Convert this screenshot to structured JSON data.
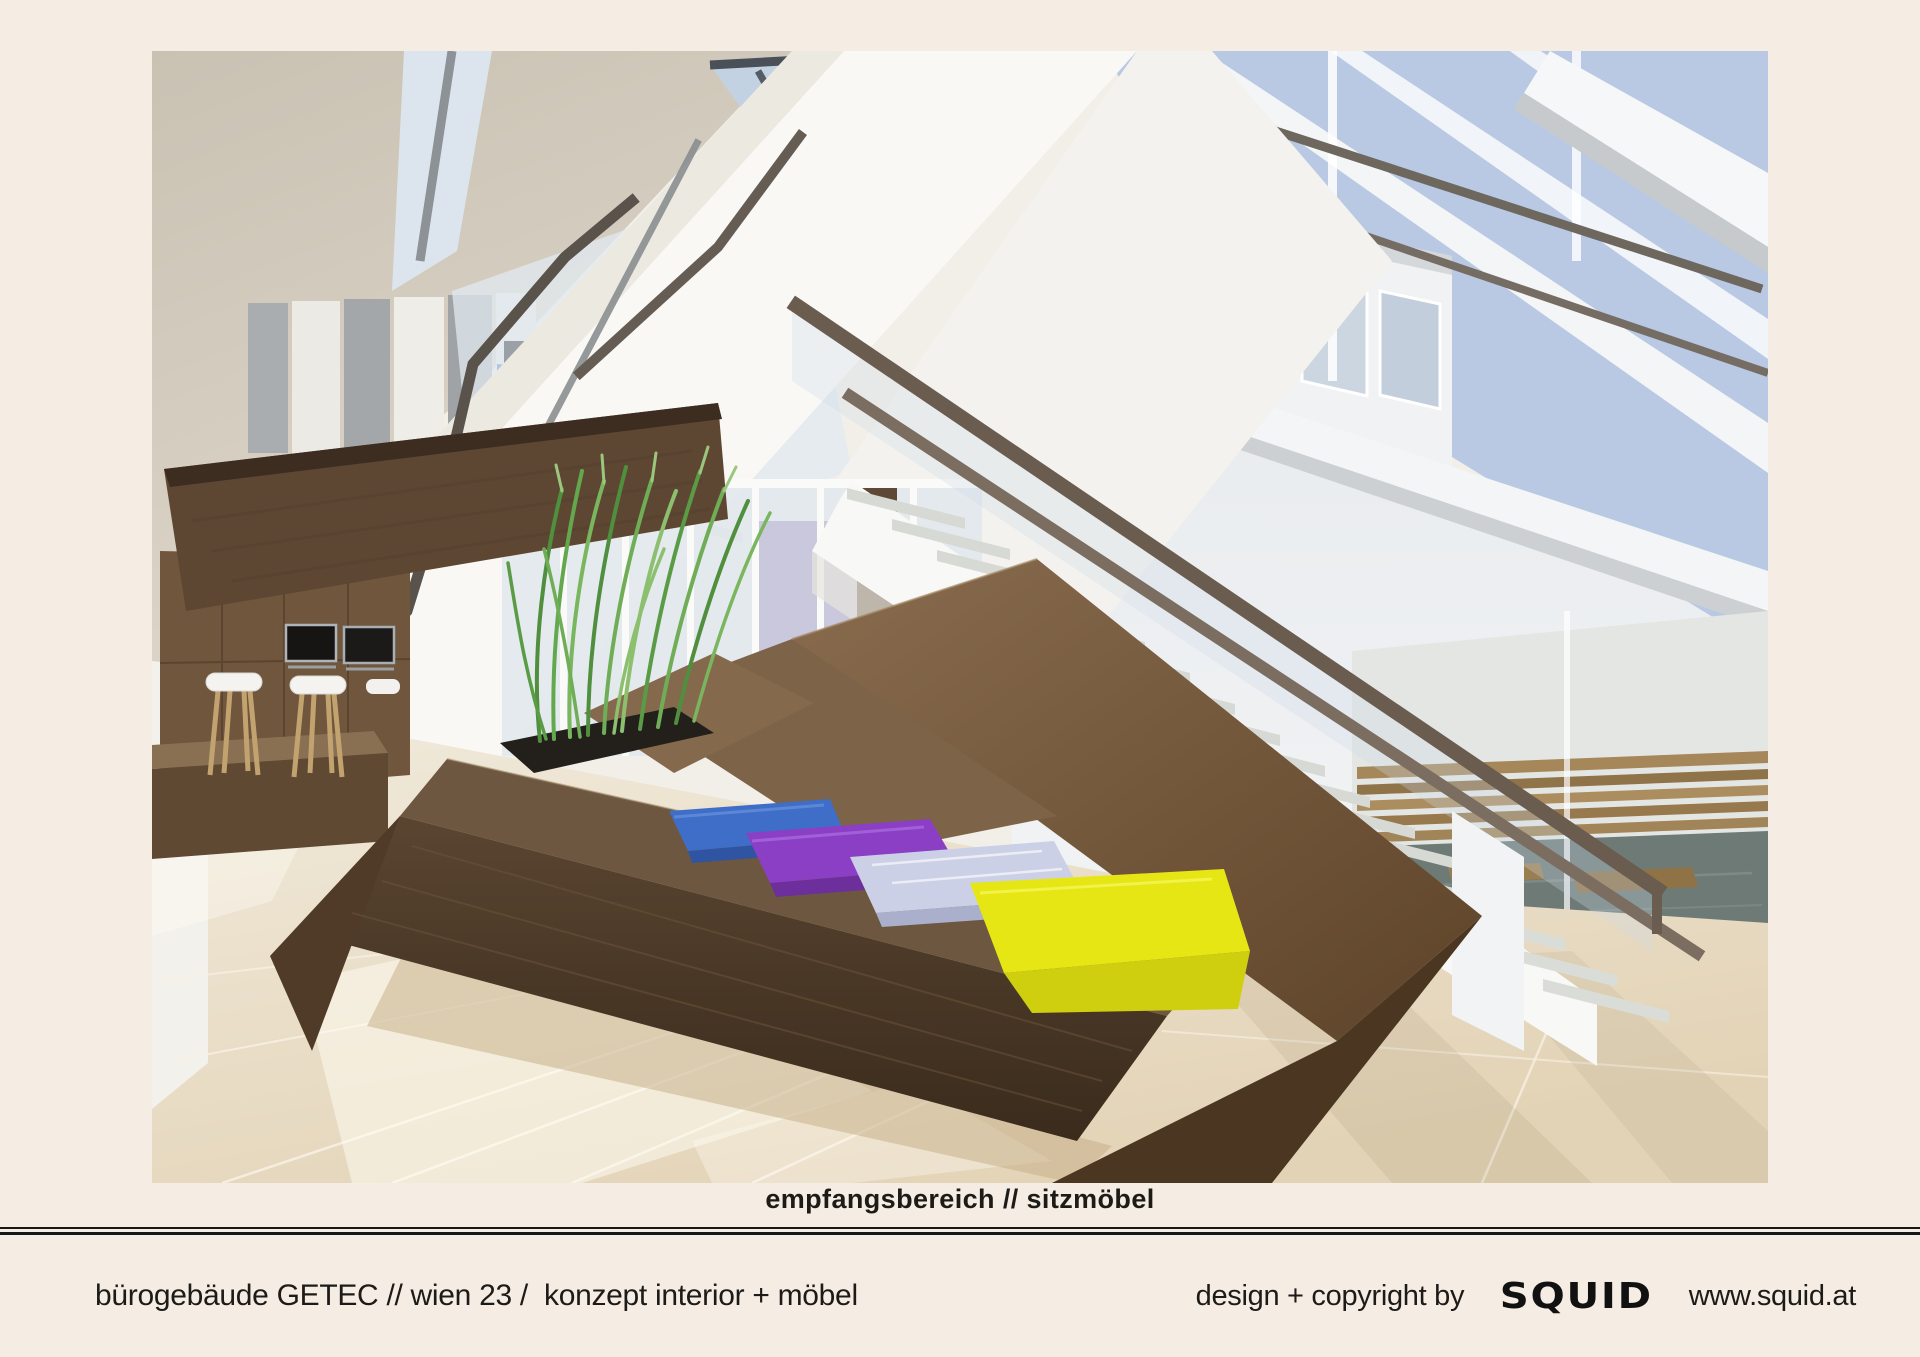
{
  "page": {
    "background_color": "#f5ece4",
    "caption": "empfangsbereich // sitzmöbel"
  },
  "footer": {
    "project": "bürogebäude GETEC // wien 23 /  konzept interior + möbel",
    "credit": "design + copyright by",
    "brand": "SQUID",
    "website": "www.squid.at",
    "rule_color": "#171717",
    "text_color": "#1d1b18"
  },
  "rendering": {
    "description": "3D-Rendering Empfangsbereich: skulpturales Sitzmöbel aus Holz mit vier bunten Sitzkissen und Gräser-Pflanztrog, Teeküche mit Barhockern, weiße Treppen mit Glasgeländer und Bronze-Handläufen, Glasfassade mit Blick auf Holzdeck und Wasserbecken",
    "colors": {
      "cushion_blue": "#3e6ec7",
      "cushion_purple": "#8b3fc5",
      "cushion_lavender": "#ccd0e6",
      "cushion_yellow": "#e6e614",
      "wood": "#6e5740",
      "sky": "#b9c9e3",
      "floor": "#ece2cd"
    }
  }
}
